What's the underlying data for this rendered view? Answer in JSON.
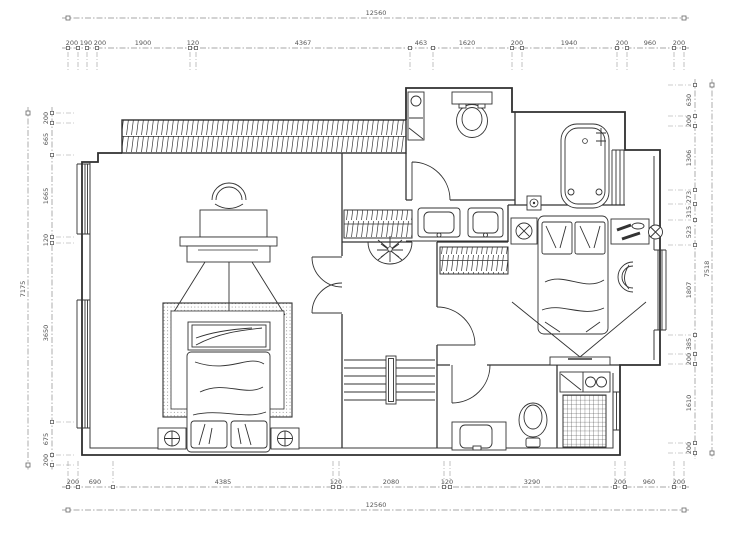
{
  "dimensions": {
    "top": {
      "total": "12560",
      "segments": [
        "200",
        "190",
        "200",
        "1900",
        "120",
        "4367",
        "463",
        "1620",
        "200",
        "1940",
        "200",
        "960",
        "200"
      ]
    },
    "bottom": {
      "total": "12560",
      "segments": [
        "200",
        "690",
        "4385",
        "120",
        "2080",
        "120",
        "3290",
        "200",
        "960",
        "200"
      ]
    },
    "left": {
      "total": "7175",
      "segments": [
        "200",
        "665",
        "1665",
        "120",
        "3650",
        "675",
        "200"
      ]
    },
    "right": {
      "total": "7518",
      "segments": [
        "630",
        "200",
        "1306",
        "273",
        "315",
        "523",
        "1807",
        "385",
        "200",
        "1610",
        "200"
      ]
    }
  },
  "colors": {
    "wall": "#2f2f2f",
    "dimension_line": "#8a8a8a",
    "background": "#ffffff"
  },
  "furniture_icons": [
    "desk-chair-icon",
    "desk-monitor-icon",
    "double-bed-icon",
    "nightstand-lamp-icon",
    "wardrobe-hatch-icon",
    "plant-icon",
    "double-door-icon",
    "door-arc-icon",
    "stairs-icon",
    "vanity-double-sink-icon",
    "toilet-icon",
    "bathtub-icon",
    "washer-icon",
    "bed-pillows-icon",
    "dresser-icon",
    "stool-icon",
    "tv-icon",
    "kitchen-sink-icon",
    "tile-grid-icon",
    "washbasin-icon",
    "window-icon"
  ]
}
